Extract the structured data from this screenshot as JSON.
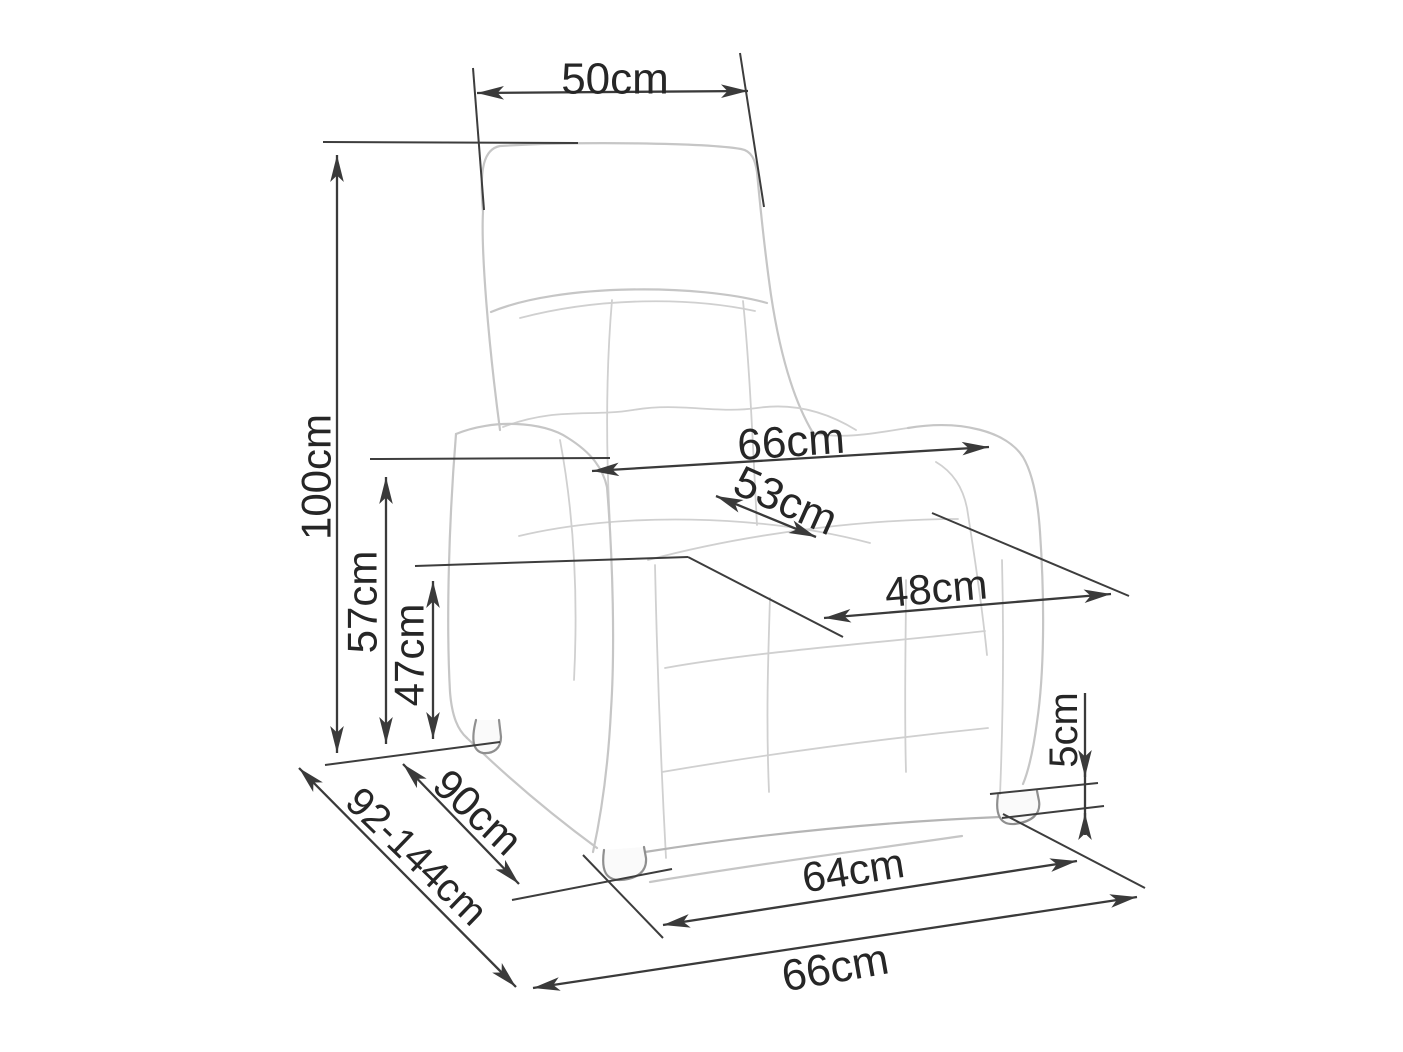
{
  "page": {
    "background": "#ffffff"
  },
  "diagram": {
    "object": "recliner armchair dimension drawing",
    "style": {
      "dimension_color": "#3a3a3a",
      "sketch_color": "#c6c6c6",
      "label_color": "#262626"
    },
    "dimensions": [
      {
        "name": "headrest-width",
        "label": "50cm",
        "orientation": "horizontal"
      },
      {
        "name": "overall-height",
        "label": "100cm",
        "orientation": "vertical"
      },
      {
        "name": "armrest-height",
        "label": "57cm",
        "orientation": "vertical"
      },
      {
        "name": "seat-height",
        "label": "47cm",
        "orientation": "vertical"
      },
      {
        "name": "overall-width",
        "label": "66cm",
        "orientation": "horizontal"
      },
      {
        "name": "seat-width",
        "label": "53cm",
        "orientation": "diagonal"
      },
      {
        "name": "seat-depth",
        "label": "48cm",
        "orientation": "horizontal"
      },
      {
        "name": "leg-height",
        "label": "5cm",
        "orientation": "vertical"
      },
      {
        "name": "depth",
        "label": "90cm",
        "orientation": "diagonal"
      },
      {
        "name": "reclined-depth",
        "label": "92-144cm",
        "orientation": "diagonal"
      },
      {
        "name": "front-base-width",
        "label": "64cm",
        "orientation": "horizontal"
      },
      {
        "name": "overall-front-width",
        "label": "66cm",
        "orientation": "horizontal"
      }
    ]
  }
}
